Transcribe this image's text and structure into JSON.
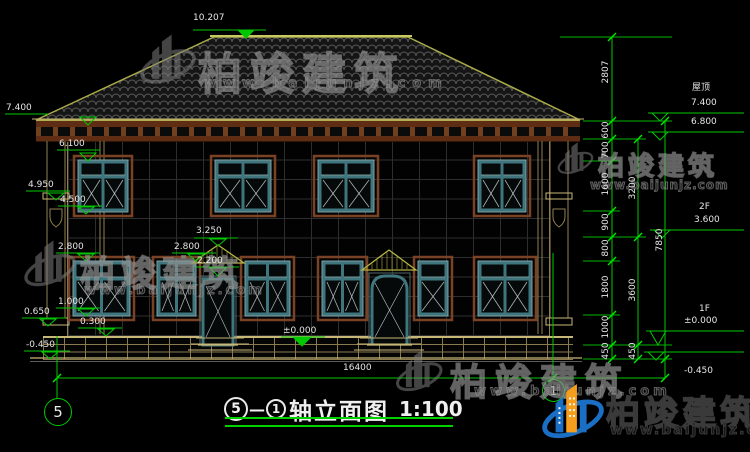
{
  "title": {
    "axis_a": "5",
    "dash": "—",
    "axis_b": "1",
    "name": "轴立面图",
    "scale": "1:100"
  },
  "axes": {
    "left": "5",
    "right": "1"
  },
  "watermark": {
    "brand": "柏竣建筑",
    "url": "www.baijunjz.com"
  },
  "drawing": {
    "type": "architectural-elevation",
    "total_width_dim": "16400",
    "ridge_level": "10.207",
    "story_labels": [
      "屋顶",
      "2F",
      "1F"
    ]
  },
  "annotations": [
    {
      "x": 6,
      "y": 103,
      "text": "7.400"
    },
    {
      "x": 59,
      "y": 139,
      "text": "6.100"
    },
    {
      "x": 28,
      "y": 180,
      "text": "4.950"
    },
    {
      "x": 60,
      "y": 195,
      "text": "4.500"
    },
    {
      "x": 58,
      "y": 242,
      "text": "2.800"
    },
    {
      "x": 58,
      "y": 297,
      "text": "1.000"
    },
    {
      "x": 24,
      "y": 307,
      "text": "0.650"
    },
    {
      "x": 80,
      "y": 317,
      "text": "0.300"
    },
    {
      "x": 26,
      "y": 340,
      "text": "-0.450"
    },
    {
      "x": 174,
      "y": 242,
      "text": "2.800"
    },
    {
      "x": 196,
      "y": 226,
      "text": "3.250"
    },
    {
      "x": 197,
      "y": 256,
      "text": "2.200"
    },
    {
      "x": 283,
      "y": 326,
      "text": "±0.000"
    },
    {
      "x": 193,
      "y": 13,
      "text": "10.207"
    },
    {
      "x": 343,
      "y": 363,
      "text": "16400"
    },
    {
      "x": 692,
      "y": 83,
      "text": "屋顶"
    },
    {
      "x": 691,
      "y": 98,
      "text": "7.400"
    },
    {
      "x": 691,
      "y": 117,
      "text": "6.800"
    },
    {
      "x": 699,
      "y": 202,
      "text": "2F"
    },
    {
      "x": 694,
      "y": 215,
      "text": "3.600"
    },
    {
      "x": 699,
      "y": 304,
      "text": "1F"
    },
    {
      "x": 684,
      "y": 316,
      "text": "±0.000"
    },
    {
      "x": 684,
      "y": 366,
      "text": "-0.450"
    },
    {
      "x": 606,
      "y": 72,
      "text": "2807",
      "rot": 1
    },
    {
      "x": 606,
      "y": 130,
      "text": "600",
      "rot": 1
    },
    {
      "x": 606,
      "y": 150,
      "text": "700",
      "rot": 1
    },
    {
      "x": 606,
      "y": 184,
      "text": "1600",
      "rot": 1
    },
    {
      "x": 606,
      "y": 222,
      "text": "900",
      "rot": 1
    },
    {
      "x": 606,
      "y": 248,
      "text": "800",
      "rot": 1
    },
    {
      "x": 606,
      "y": 287,
      "text": "1800",
      "rot": 1
    },
    {
      "x": 606,
      "y": 327,
      "text": "1000",
      "rot": 1
    },
    {
      "x": 606,
      "y": 351,
      "text": "450",
      "rot": 1
    },
    {
      "x": 633,
      "y": 188,
      "text": "3200",
      "rot": 1
    },
    {
      "x": 633,
      "y": 290,
      "text": "3600",
      "rot": 1
    },
    {
      "x": 633,
      "y": 351,
      "text": "450",
      "rot": 1
    },
    {
      "x": 660,
      "y": 240,
      "text": "7850",
      "rot": 1
    }
  ]
}
